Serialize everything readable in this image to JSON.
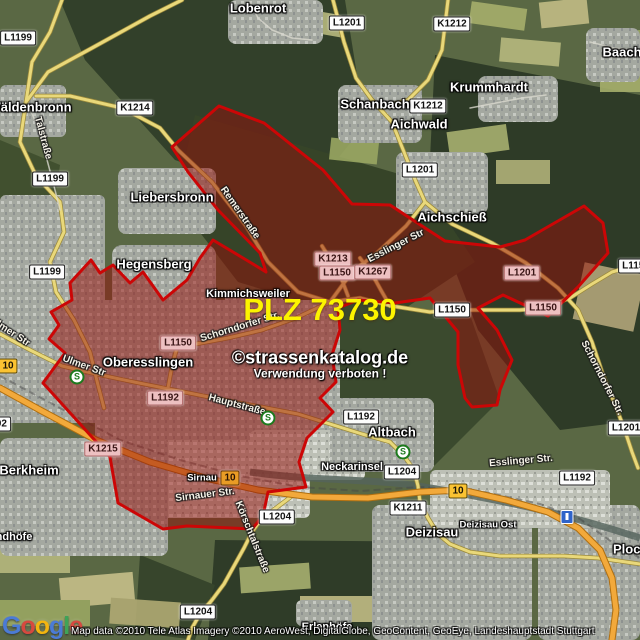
{
  "map": {
    "plz_label": "PLZ 73730",
    "plz_color": "#fcf400",
    "zone_border_color": "#cc0606",
    "zone_fill_color": "rgba(150,14,8,0.5)",
    "watermark": {
      "line1": "©strassenkatalog.de",
      "line2": "Verwendung verboten !"
    },
    "attribution": "Map data ©2010 Tele Atlas  Imagery ©2010 AeroWest, DigitalGlobe, GeoContent, GeoEye, Landeshauptstadt Stuttgart",
    "logo": {
      "text": "Google",
      "letters": [
        {
          "ch": "G",
          "color": "#4b7bd6"
        },
        {
          "ch": "o",
          "color": "#d6493f"
        },
        {
          "ch": "o",
          "color": "#f2b50f"
        },
        {
          "ch": "g",
          "color": "#4b7bd6"
        },
        {
          "ch": "l",
          "color": "#3fa357"
        },
        {
          "ch": "e",
          "color": "#d6493f"
        }
      ]
    },
    "road_shields": [
      {
        "style": "white",
        "label": "L1199",
        "x": 18,
        "y": 38
      },
      {
        "style": "white",
        "label": "K1214",
        "x": 135,
        "y": 108
      },
      {
        "style": "white",
        "label": "L1201",
        "x": 347,
        "y": 23
      },
      {
        "style": "white",
        "label": "K1212",
        "x": 452,
        "y": 24
      },
      {
        "style": "white",
        "label": "K1212",
        "x": 428,
        "y": 106
      },
      {
        "style": "white",
        "label": "L1199",
        "x": 50,
        "y": 179
      },
      {
        "style": "white",
        "label": "L1199",
        "x": 47,
        "y": 272
      },
      {
        "style": "white",
        "label": "L1201",
        "x": 420,
        "y": 170
      },
      {
        "style": "white",
        "label": "L1150",
        "x": 452,
        "y": 310
      },
      {
        "style": "white",
        "label": "L1150",
        "x": 636,
        "y": 266
      },
      {
        "style": "white",
        "label": "L1192",
        "x": -7,
        "y": 424
      },
      {
        "style": "white",
        "label": "L1192",
        "x": 361,
        "y": 417
      },
      {
        "style": "white",
        "label": "L1204",
        "x": 402,
        "y": 472
      },
      {
        "style": "white",
        "label": "L1192",
        "x": 577,
        "y": 478
      },
      {
        "style": "white",
        "label": "L1201",
        "x": 626,
        "y": 428
      },
      {
        "style": "white",
        "label": "K1211",
        "x": 408,
        "y": 508
      },
      {
        "style": "white",
        "label": "L1204",
        "x": 277,
        "y": 517
      },
      {
        "style": "white",
        "label": "L1204",
        "x": 198,
        "y": 612
      },
      {
        "style": "pink",
        "label": "K1213",
        "x": 333,
        "y": 259
      },
      {
        "style": "pink",
        "label": "L1150",
        "x": 337,
        "y": 273
      },
      {
        "style": "pink",
        "label": "K1267",
        "x": 373,
        "y": 272
      },
      {
        "style": "pink",
        "label": "L1201",
        "x": 522,
        "y": 273
      },
      {
        "style": "pink",
        "label": "L1150",
        "x": 543,
        "y": 308
      },
      {
        "style": "pink",
        "label": "L1150",
        "x": 178,
        "y": 343
      },
      {
        "style": "pink",
        "label": "L1192",
        "x": 165,
        "y": 398
      },
      {
        "style": "pink",
        "label": "K1215",
        "x": 103,
        "y": 449
      },
      {
        "style": "b10",
        "label": "10",
        "x": 8,
        "y": 366
      },
      {
        "style": "b10t",
        "label": "10",
        "x": 230,
        "y": 478
      },
      {
        "style": "b10",
        "label": "10",
        "x": 458,
        "y": 491
      }
    ],
    "place_labels": [
      {
        "name": "Lobenrot",
        "x": 258,
        "y": 8,
        "size": "lg"
      },
      {
        "name": "Baach",
        "x": 622,
        "y": 52,
        "size": "lg"
      },
      {
        "name": "Wäldenbronn",
        "x": 30,
        "y": 107,
        "size": "lg"
      },
      {
        "name": "Schanbach",
        "x": 375,
        "y": 104,
        "size": "lg"
      },
      {
        "name": "Krummhardt",
        "x": 489,
        "y": 87,
        "size": "lg"
      },
      {
        "name": "Aichwald",
        "x": 419,
        "y": 124,
        "size": "lg"
      },
      {
        "name": "Liebersbronn",
        "x": 172,
        "y": 197,
        "size": "lg"
      },
      {
        "name": "Aichschieß",
        "x": 452,
        "y": 217,
        "size": "lg"
      },
      {
        "name": "Hegensberg",
        "x": 154,
        "y": 264,
        "size": "lg"
      },
      {
        "name": "Kimmichsweiler",
        "x": 248,
        "y": 294,
        "size": "md"
      },
      {
        "name": "Oberesslingen",
        "x": 148,
        "y": 362,
        "size": "lg"
      },
      {
        "name": "Berkheim",
        "x": 29,
        "y": 470,
        "size": "lg"
      },
      {
        "name": "Sirnau",
        "x": 202,
        "y": 478,
        "size": "sm"
      },
      {
        "name": "Neckarinsel",
        "x": 352,
        "y": 467,
        "size": "md"
      },
      {
        "name": "Altbach",
        "x": 392,
        "y": 432,
        "size": "lg"
      },
      {
        "name": "Deizisau",
        "x": 432,
        "y": 532,
        "size": "lg"
      },
      {
        "name": "Deizisau Ost",
        "x": 488,
        "y": 525,
        "size": "sm"
      },
      {
        "name": "Erlenhöfe",
        "x": 327,
        "y": 627,
        "size": "md"
      },
      {
        "name": "Plochingen",
        "x": 648,
        "y": 549,
        "size": "lg"
      },
      {
        "name": "ndhöfe",
        "x": 14,
        "y": 537,
        "size": "md"
      }
    ],
    "street_labels": [
      {
        "name": "Talstraße",
        "x": 43,
        "y": 138,
        "rotate": 75
      },
      {
        "name": "Remerstraße",
        "x": 240,
        "y": 213,
        "rotate": 55
      },
      {
        "name": "Ulmer Str",
        "x": 10,
        "y": 332,
        "rotate": 33
      },
      {
        "name": "Ulmer Str",
        "x": 84,
        "y": 366,
        "rotate": 20
      },
      {
        "name": "Schorndorfer Str.",
        "x": 240,
        "y": 327,
        "rotate": -17
      },
      {
        "name": "Schorndorfer Str.",
        "x": 602,
        "y": 378,
        "rotate": 63
      },
      {
        "name": "Esslinger Str",
        "x": 396,
        "y": 246,
        "rotate": -27
      },
      {
        "name": "Esslinger Str.",
        "x": 521,
        "y": 461,
        "rotate": -5
      },
      {
        "name": "Hauptstraße",
        "x": 237,
        "y": 405,
        "rotate": 15
      },
      {
        "name": "Sirnauer Str.",
        "x": 205,
        "y": 495,
        "rotate": -7
      },
      {
        "name": "Körschtalstraße",
        "x": 252,
        "y": 537,
        "rotate": 68
      }
    ],
    "transit_icons": [
      {
        "type": "sbahn",
        "x": 77,
        "y": 377
      },
      {
        "type": "sbahn",
        "x": 268,
        "y": 418
      },
      {
        "type": "sbahn",
        "x": 403,
        "y": 452
      },
      {
        "type": "station",
        "x": 567,
        "y": 517
      }
    ]
  }
}
